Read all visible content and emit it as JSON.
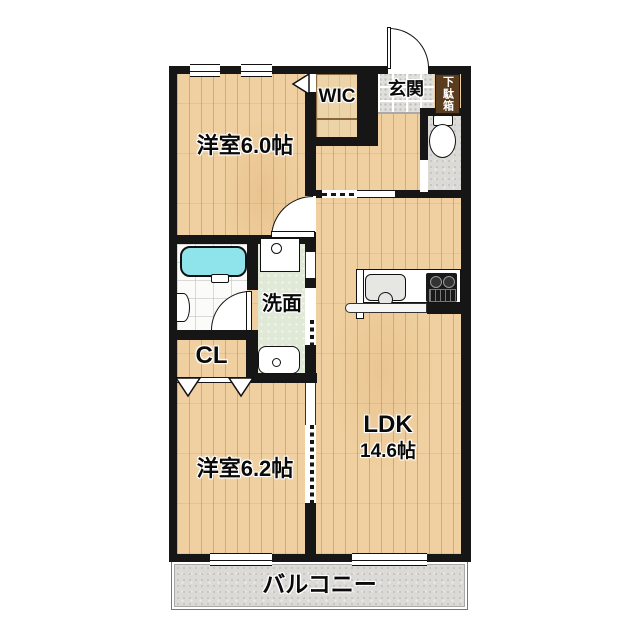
{
  "rooms": {
    "bedroom_top": {
      "label": "洋室6.0帖"
    },
    "wic": {
      "label": "WIC"
    },
    "entrance": {
      "label": "玄関"
    },
    "shoe_cabinet": {
      "label": "下駄箱"
    },
    "washroom": {
      "label": "洗面"
    },
    "closet": {
      "label": "CL"
    },
    "ldk": {
      "label": "LDK",
      "size": "14.6帖"
    },
    "bedroom_bottom": {
      "label": "洋室6.2帖"
    },
    "balcony": {
      "label": "バルコニー"
    }
  },
  "fixtures": [
    "bathtub",
    "bath-door-arc",
    "bath-side-basin",
    "vanity-sink",
    "washing-machine-pan",
    "toilet",
    "kitchen-counter",
    "kitchen-sink",
    "gas-stove",
    "entrance-door-arc",
    "bedroom-door-arc",
    "wic-folding-door-marker",
    "closet-folding-door-markers",
    "accordion-door",
    "windows"
  ],
  "colors": {
    "wall": "#161616",
    "wood_floor": "#f0d0a0",
    "wic_floor": "#ecd4a8",
    "bathtub": "#8fe3ea",
    "washroom_floor": "#e0e8d6",
    "entrance_tile": "#e0dfdb",
    "toilet_floor": "#dbdad6",
    "balcony_floor": "#dbdad6",
    "shoe_cabinet": "#5a3c1e",
    "background": "#ffffff"
  }
}
